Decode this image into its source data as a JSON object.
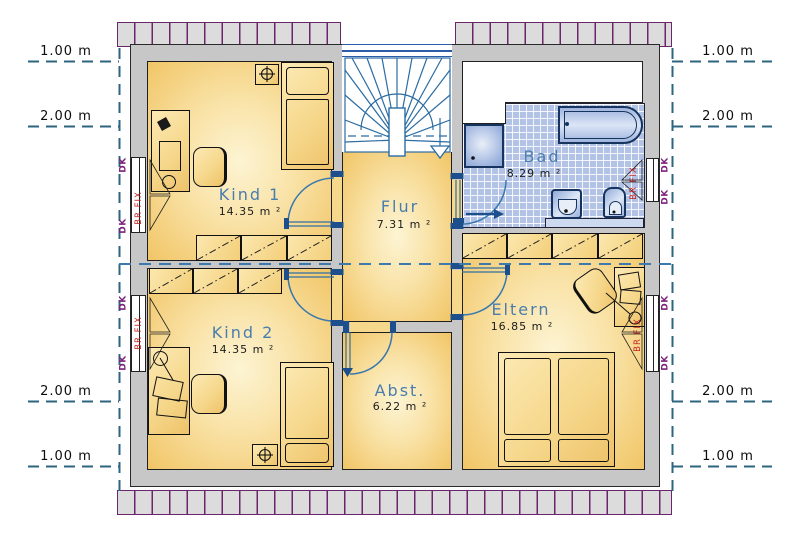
{
  "plan": {
    "rooms": {
      "kind1": {
        "name": "Kind 1",
        "area": "14.35 m ²"
      },
      "kind2": {
        "name": "Kind 2",
        "area": "14.35 m ²"
      },
      "flur": {
        "name": "Flur",
        "area": "7.31 m ²"
      },
      "bad": {
        "name": "Bad",
        "area": "8.29 m ²"
      },
      "abst": {
        "name": "Abst.",
        "area": "6.22 m ²"
      },
      "eltern": {
        "name": "Eltern",
        "area": "16.85 m ²"
      }
    },
    "dimensions": {
      "left": [
        "1.00 m",
        "2.00 m",
        "2.00 m",
        "1.00 m"
      ],
      "right": [
        "1.00 m",
        "2.00 m",
        "2.00 m",
        "1.00 m"
      ]
    },
    "window_labels": {
      "dk": "DK",
      "brfix": "BR FIX"
    },
    "colors": {
      "room_fill": "#f1c566",
      "tile_blue": "#b2c3e6",
      "wall_gray": "#c7c7c7",
      "line_blue": "#2b6ca3",
      "label_blue": "#4a7dad",
      "dk_purple": "#7b1f7b",
      "brfix_red": "#c11f1f",
      "hatch_purple": "#6b256b",
      "dim_teal": "#2d6580"
    }
  }
}
